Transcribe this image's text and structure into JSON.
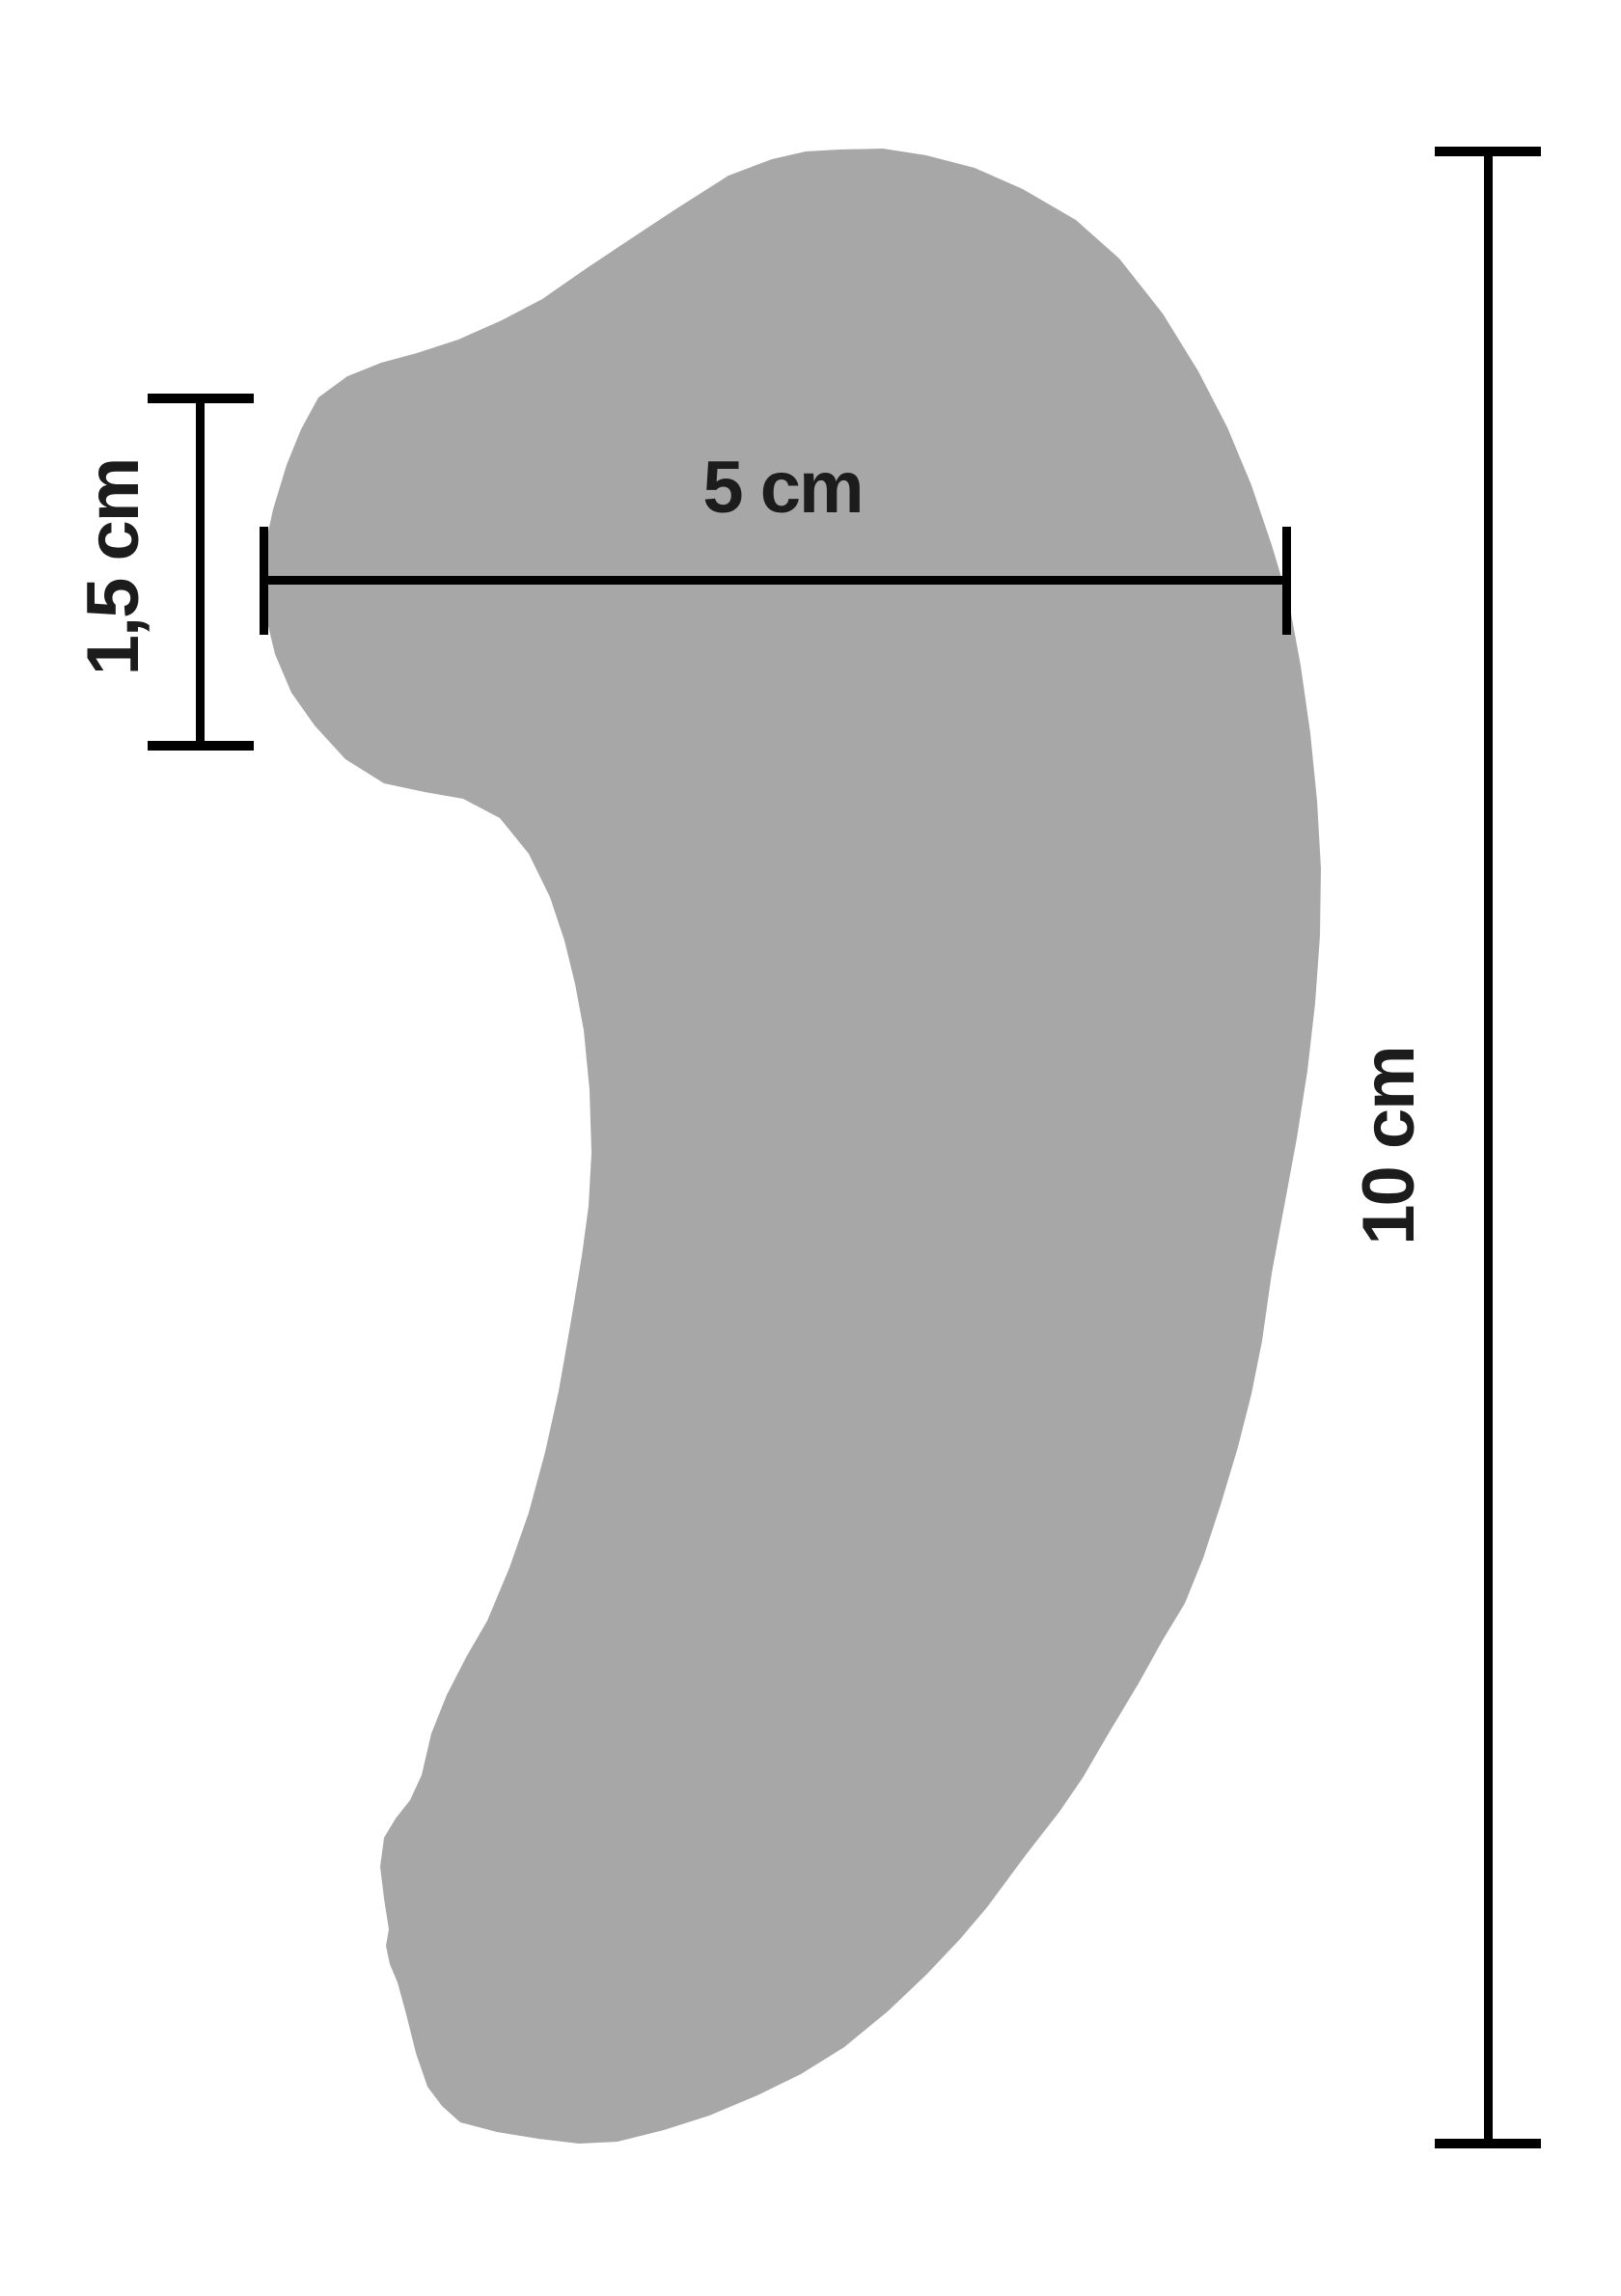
{
  "labels": {
    "width": "5 cm",
    "height": "10 cm",
    "thickness": "1,5 cm"
  },
  "colors": {
    "background": "#ffffff",
    "shape_fill": "#a7a7a7",
    "line": "#000000",
    "text": "#1c1c1c"
  }
}
